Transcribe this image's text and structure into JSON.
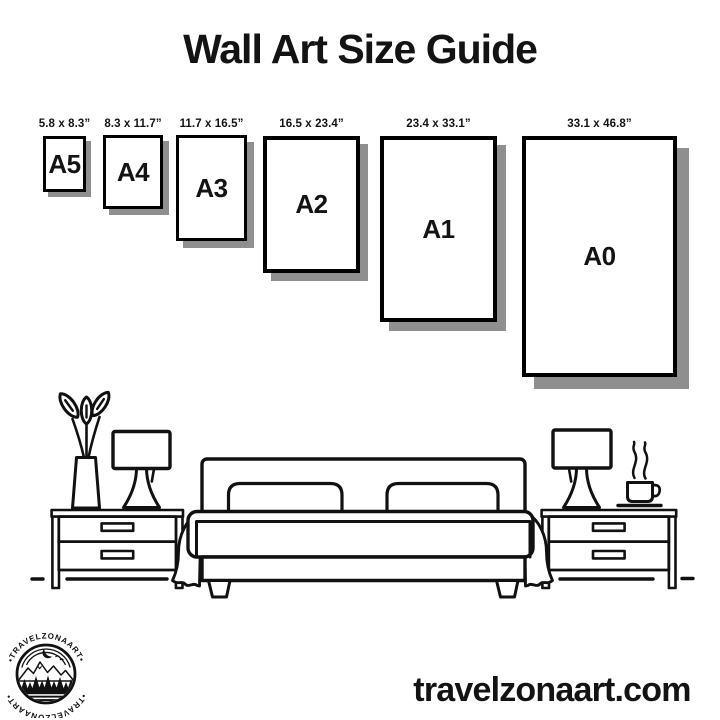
{
  "title": "Wall Art Size Guide",
  "sizes": [
    {
      "name": "A5",
      "dimensions": "5.8 x 8.3”"
    },
    {
      "name": "A4",
      "dimensions": "8.3 x 11.7”"
    },
    {
      "name": "A3",
      "dimensions": "11.7 x 16.5”"
    },
    {
      "name": "A2",
      "dimensions": "16.5 x 23.4”"
    },
    {
      "name": "A1",
      "dimensions": "23.4 x 33.1”"
    },
    {
      "name": "A0",
      "dimensions": "33.1 x 46.8”"
    }
  ],
  "scene": {
    "furniture": [
      "potted-plant",
      "table-lamp",
      "nightstand",
      "double-bed",
      "nightstand",
      "table-lamp",
      "coffee-cup"
    ]
  },
  "logo": {
    "arc_text_top": "•TRAVELZONAART•",
    "arc_text_bottom": "•TRAVELZONAART•"
  },
  "website": "travelzonaart.com",
  "colors": {
    "ink": "#111111",
    "shadow": "#8f8f8f",
    "background": "#ffffff"
  }
}
